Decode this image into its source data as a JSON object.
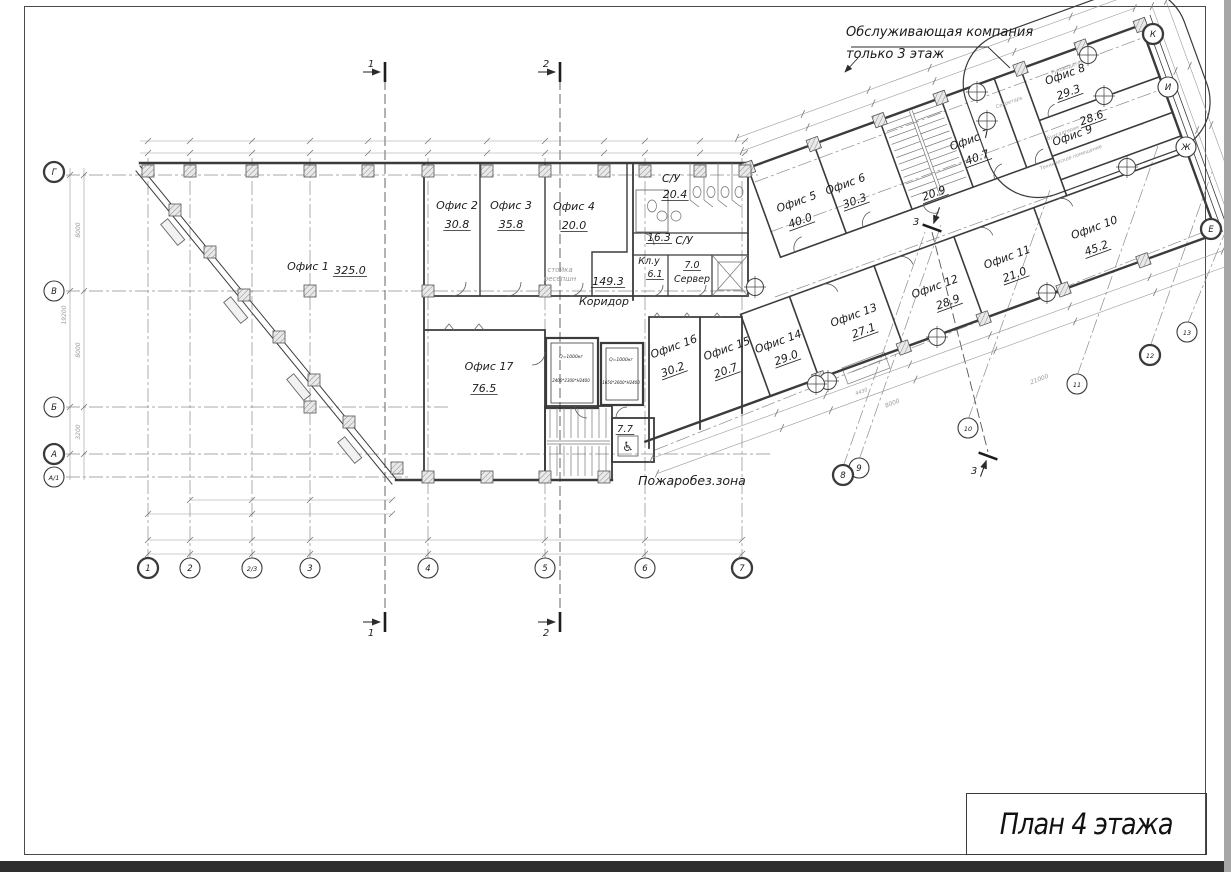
{
  "sheet": {
    "title": "План 4 этажа"
  },
  "annotation": {
    "line1": "Обслуживающая компания",
    "line2": "только 3 этаж"
  },
  "colors": {
    "wall": "#3b3b3b",
    "thin": "#9a9a9a",
    "text": "#1c1c1c",
    "muted": "#9a9a9a"
  },
  "rooms": [
    {
      "frame": "plan",
      "name": "Офис 1",
      "area": "325.0",
      "nx": 308,
      "ny": 270,
      "ax": 350,
      "ay": 274
    },
    {
      "frame": "plan",
      "name": "Офис 2",
      "area": "30.8",
      "nx": 457,
      "ny": 209,
      "ax": 457,
      "ay": 228
    },
    {
      "frame": "plan",
      "name": "Офис 3",
      "area": "35.8",
      "nx": 511,
      "ny": 209,
      "ax": 511,
      "ay": 228
    },
    {
      "frame": "plan",
      "name": "Офис 4",
      "area": "20.0",
      "nx": 574,
      "ny": 210,
      "ax": 574,
      "ay": 229
    },
    {
      "frame": "plan",
      "name": "Офис 17",
      "area": "76.5",
      "nx": 489,
      "ny": 370,
      "ax": 484,
      "ay": 392
    },
    {
      "frame": "plan",
      "name": "Офис 16",
      "area": "30.2",
      "nx": 675,
      "ny": 350,
      "ax": 674,
      "ay": 373,
      "rot": -20
    },
    {
      "frame": "plan",
      "name": "Офис 15",
      "area": "20.7",
      "nx": 728,
      "ny": 352,
      "ax": 727,
      "ay": 374,
      "rot": -20
    },
    {
      "frame": "wing",
      "name": "Офис 5",
      "area": "40.0",
      "nx": 34,
      "ny": 52,
      "ax": 31,
      "ay": 71
    },
    {
      "frame": "wing",
      "name": "Офис 6",
      "area": "30.3",
      "nx": 86,
      "ny": 52,
      "ax": 89,
      "ay": 71
    },
    {
      "frame": "wing",
      "name": "Офис 7",
      "area": "40.7",
      "nx": 218,
      "ny": 53,
      "ax": 219,
      "ay": 72
    },
    {
      "frame": "wing",
      "name": "Офис 8",
      "area": "29.3",
      "nx": 330,
      "ny": 24,
      "ax": 327,
      "ay": 42
    },
    {
      "frame": "wing",
      "name": "Офис 9",
      "area": "28.6",
      "nx": 316,
      "ny": 84,
      "ax": 340,
      "ay": 74
    },
    {
      "frame": "wing",
      "name": "Офис 10",
      "area": "45.2",
      "nx": 305,
      "ny": 178,
      "ax": 300,
      "ay": 198
    },
    {
      "frame": "wing",
      "name": "Офис 11",
      "area": "21.0",
      "nx": 213,
      "ny": 176,
      "ax": 214,
      "ay": 195
    },
    {
      "frame": "wing",
      "name": "Офис 12",
      "area": "28.9",
      "nx": 135,
      "ny": 179,
      "ax": 142,
      "ay": 198
    },
    {
      "frame": "wing",
      "name": "Офис 13",
      "area": "27.1",
      "nx": 49,
      "ny": 178,
      "ax": 53,
      "ay": 196
    },
    {
      "frame": "wing",
      "name": "Офис 14",
      "area": "29.0",
      "nx": -31,
      "ny": 177,
      "ax": -29,
      "ay": 195
    }
  ],
  "labels_plan": [
    {
      "t": "С/У",
      "x": 671,
      "y": 182,
      "s": 11
    },
    {
      "t": "20.4",
      "x": 675,
      "y": 198,
      "s": 11,
      "u": 1
    },
    {
      "t": "16.3",
      "x": 659,
      "y": 241,
      "s": 10.5,
      "u": 1
    },
    {
      "t": "С/У",
      "x": 684,
      "y": 244,
      "s": 10.5
    },
    {
      "t": "Кл.у",
      "x": 649,
      "y": 264,
      "s": 9.5
    },
    {
      "t": "6.1",
      "x": 655,
      "y": 277,
      "s": 9.5,
      "u": 1
    },
    {
      "t": "7.0",
      "x": 692,
      "y": 268,
      "s": 9.5,
      "u": 1
    },
    {
      "t": "Сервер",
      "x": 692,
      "y": 282,
      "s": 9.5
    },
    {
      "t": "149.3",
      "x": 608,
      "y": 285,
      "s": 11,
      "u": 1
    },
    {
      "t": "Коридор",
      "x": 604,
      "y": 305,
      "s": 11
    },
    {
      "t": "стойка",
      "x": 560,
      "y": 272,
      "s": 7,
      "c": "muted"
    },
    {
      "t": "ресепшн",
      "x": 560,
      "y": 281,
      "s": 7,
      "c": "muted"
    },
    {
      "t": "7.7",
      "x": 625,
      "y": 432,
      "s": 10,
      "u": 1
    },
    {
      "t": "Пожаробез.зона",
      "x": 692,
      "y": 485,
      "s": 12.5
    },
    {
      "t": "Q=1000кг",
      "x": 571,
      "y": 358,
      "s": 4.5
    },
    {
      "t": "2400*2300*H2400",
      "x": 571,
      "y": 382,
      "s": 4
    },
    {
      "t": "Q=1000кг",
      "x": 621,
      "y": 361,
      "s": 4.5
    },
    {
      "t": "1650*2600*H2400",
      "x": 621,
      "y": 384,
      "s": 4
    },
    {
      "t": "8000",
      "x": 80,
      "y": 230,
      "s": 6,
      "rot": -90,
      "c": "thin"
    },
    {
      "t": "8000",
      "x": 80,
      "y": 350,
      "s": 6,
      "rot": -90,
      "c": "thin"
    },
    {
      "t": "3200",
      "x": 80,
      "y": 432,
      "s": 6,
      "rot": -90,
      "c": "thin"
    },
    {
      "t": "19200",
      "x": 66,
      "y": 315,
      "s": 6,
      "rot": -90,
      "c": "thin"
    },
    {
      "t": "21000",
      "x": 1040,
      "y": 381,
      "s": 6,
      "rot": -21,
      "c": "thin"
    },
    {
      "t": "8000",
      "x": 893,
      "y": 405,
      "s": 6,
      "rot": -21,
      "c": "thin"
    },
    {
      "t": "4430",
      "x": 862,
      "y": 393,
      "s": 5,
      "rot": -21,
      "c": "thin"
    }
  ],
  "labels_wing": [
    {
      "t": "Руководитель",
      "x": 336,
      "y": 16,
      "s": 5,
      "c": "muted"
    },
    {
      "t": "Секретарь",
      "x": 268,
      "y": 29,
      "s": 5,
      "c": "muted"
    },
    {
      "t": "Бухгалтерия",
      "x": 308,
      "y": 76,
      "s": 5,
      "c": "muted"
    },
    {
      "t": "Техническое помещение",
      "x": 307,
      "y": 102,
      "s": 5,
      "c": "muted"
    },
    {
      "t": "20.9",
      "x": 166,
      "y": 91,
      "s": 11,
      "u": 1
    }
  ],
  "grid_bubbles": [
    {
      "label": "1",
      "x": 148,
      "y": 568,
      "bold": true
    },
    {
      "label": "2",
      "x": 190,
      "y": 568
    },
    {
      "label": "2/3",
      "x": 252,
      "y": 568,
      "small": true
    },
    {
      "label": "3",
      "x": 310,
      "y": 568
    },
    {
      "label": "4",
      "x": 428,
      "y": 568
    },
    {
      "label": "5",
      "x": 545,
      "y": 568
    },
    {
      "label": "6",
      "x": 645,
      "y": 568
    },
    {
      "label": "7",
      "x": 742,
      "y": 568,
      "bold": true
    },
    {
      "label": "Г",
      "x": 54,
      "y": 172,
      "bold": true
    },
    {
      "label": "В",
      "x": 54,
      "y": 291
    },
    {
      "label": "Б",
      "x": 54,
      "y": 407
    },
    {
      "label": "А",
      "x": 54,
      "y": 454,
      "bold": true
    },
    {
      "label": "А/1",
      "x": 54,
      "y": 477,
      "small": true
    },
    {
      "label": "К",
      "x": 1153,
      "y": 34,
      "bold": true
    },
    {
      "label": "И",
      "x": 1168,
      "y": 87
    },
    {
      "label": "Ж",
      "x": 1186,
      "y": 147
    },
    {
      "label": "Е",
      "x": 1211,
      "y": 229,
      "bold": true
    },
    {
      "label": "13",
      "x": 1187,
      "y": 332,
      "small": true
    },
    {
      "label": "12",
      "x": 1150,
      "y": 355,
      "bold": true,
      "small": true
    },
    {
      "label": "11",
      "x": 1077,
      "y": 384,
      "small": true
    },
    {
      "label": "10",
      "x": 968,
      "y": 428,
      "small": true
    },
    {
      "label": "9",
      "x": 859,
      "y": 468
    },
    {
      "label": "8",
      "x": 843,
      "y": 475,
      "bold": true
    }
  ],
  "section_markers": [
    {
      "label": "1",
      "x": 385,
      "y": 72,
      "dir": 0,
      "lx": -14,
      "ly": -5
    },
    {
      "label": "1",
      "x": 385,
      "y": 622,
      "dir": 0,
      "lx": -14,
      "ly": 14
    },
    {
      "label": "2",
      "x": 560,
      "y": 72,
      "dir": 0,
      "lx": -14,
      "ly": -5
    },
    {
      "label": "2",
      "x": 560,
      "y": 622,
      "dir": 0,
      "lx": -14,
      "ly": 14
    },
    {
      "label": "3",
      "x": 932,
      "y": 228,
      "dir": 110,
      "lx": -16,
      "ly": -3
    },
    {
      "label": "3",
      "x": 988,
      "y": 456,
      "dir": -70,
      "lx": -14,
      "ly": 18
    }
  ]
}
